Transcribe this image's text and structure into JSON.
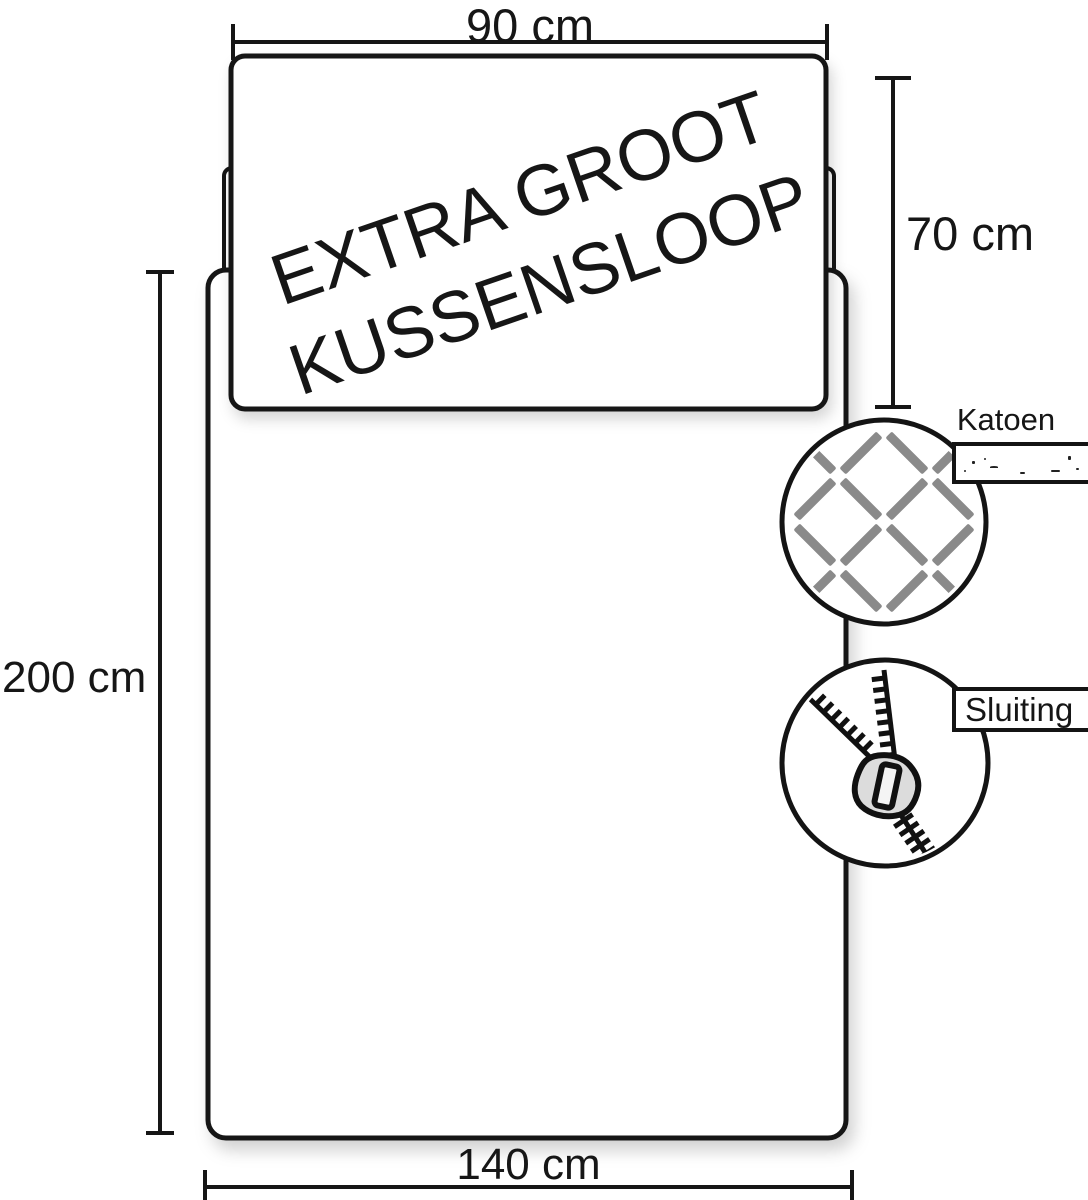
{
  "pillow": {
    "line1": "EXTRA GROOT",
    "line2": "KUSSENSLOOP"
  },
  "dimensions": {
    "pillow_width": "90 cm",
    "pillow_height": "70 cm",
    "duvet_length": "200 cm",
    "duvet_width": "140 cm"
  },
  "callouts": {
    "material_label": "Katoen",
    "closure_label": "Sluiting"
  },
  "icons": {
    "weave": "weave-icon",
    "zipper": "zipper-icon"
  },
  "colors": {
    "background": "#ffffff",
    "outline": "#161616",
    "weave_bar": "#8a8a8a",
    "zipper_slider": "#dcdcdc"
  }
}
